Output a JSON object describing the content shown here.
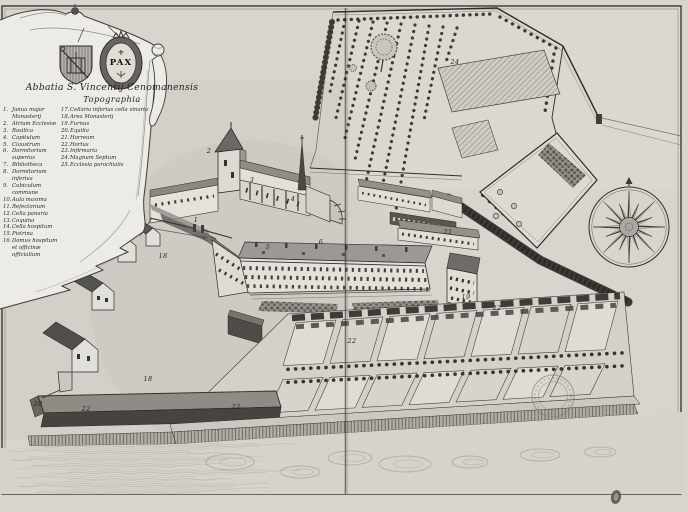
{
  "cartouche": {
    "title_line1": "Abbatia S. Vincentij Cenomanensis",
    "title_line2": "Topographia",
    "medallion_text": "PAX",
    "legend_left": [
      {
        "num": "1",
        "label": "Janua major Monasterij"
      },
      {
        "num": "2",
        "label": "Atrium Ecclesiæ"
      },
      {
        "num": "3",
        "label": "Basilica"
      },
      {
        "num": "4",
        "label": "Capitulum"
      },
      {
        "num": "5",
        "label": "Claustrum"
      },
      {
        "num": "6",
        "label": "Dormitorium superius"
      },
      {
        "num": "7",
        "label": "Bibliotheca"
      },
      {
        "num": "8",
        "label": "Dormitorium inferius"
      },
      {
        "num": "9",
        "label": "Cubiculum commune"
      },
      {
        "num": "10",
        "label": "Aula maxima"
      },
      {
        "num": "11",
        "label": "Refectorium"
      },
      {
        "num": "12",
        "label": "Cella panaria"
      },
      {
        "num": "13",
        "label": "Coquina"
      },
      {
        "num": "14",
        "label": "Cella hospitum"
      },
      {
        "num": "15",
        "label": "Pistrina"
      },
      {
        "num": "16",
        "label": "Domus hospitum et officinæ officialium"
      }
    ],
    "legend_right": [
      {
        "num": "17",
        "label": "Cellaria inferius cella vinaria"
      },
      {
        "num": "18",
        "label": "Area Monasterij"
      },
      {
        "num": "19",
        "label": "Furnus"
      },
      {
        "num": "20",
        "label": "Equilia"
      },
      {
        "num": "21",
        "label": "Horreum"
      },
      {
        "num": "22",
        "label": "Hortus"
      },
      {
        "num": "23",
        "label": "Infirmaria"
      },
      {
        "num": "24",
        "label": "Magnum Septum"
      },
      {
        "num": "25",
        "label": "Ecclesia parochialis"
      }
    ]
  },
  "map_markers": [
    {
      "label": "1",
      "x": 196,
      "y": 220
    },
    {
      "label": "2",
      "x": 209,
      "y": 151
    },
    {
      "label": "3",
      "x": 252,
      "y": 180
    },
    {
      "label": "4",
      "x": 293,
      "y": 199
    },
    {
      "label": "5",
      "x": 268,
      "y": 247
    },
    {
      "label": "6",
      "x": 321,
      "y": 242
    },
    {
      "label": "18",
      "x": 163,
      "y": 256
    },
    {
      "label": "18",
      "x": 148,
      "y": 379
    },
    {
      "label": "19",
      "x": 466,
      "y": 297
    },
    {
      "label": "20",
      "x": 38,
      "y": 404
    },
    {
      "label": "21",
      "x": 448,
      "y": 232
    },
    {
      "label": "22",
      "x": 352,
      "y": 341
    },
    {
      "label": "22",
      "x": 497,
      "y": 308
    },
    {
      "label": "22",
      "x": 86,
      "y": 409
    },
    {
      "label": "22",
      "x": 236,
      "y": 407
    },
    {
      "label": "24",
      "x": 455,
      "y": 62
    },
    {
      "label": "24",
      "x": 524,
      "y": 249
    }
  ],
  "colors": {
    "paper": "#d8d5ce",
    "ink": "#2e2d2a",
    "cloth": "#ecebe5",
    "roof_dark": "#6b6963",
    "water": "#d5d3cc"
  }
}
